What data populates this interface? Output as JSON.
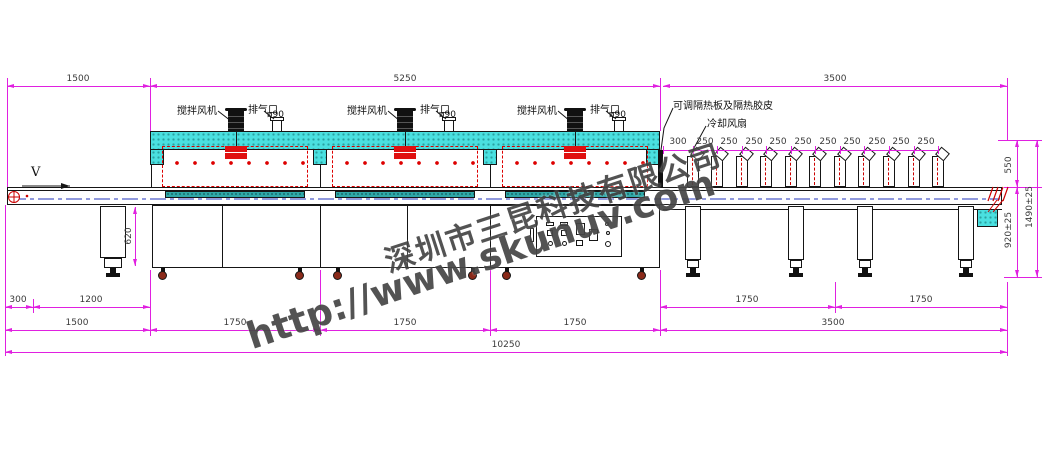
{
  "watermark": {
    "company": "深圳市三昆科技有限公司",
    "url": "http://www.skunuv.com"
  },
  "labels": {
    "stir_fan": "搅拌风机",
    "exhaust_port": "排气口",
    "exhaust_diameter": "ø90",
    "insulation": "可调隔热板及隔热胶皮",
    "cooling_fan": "冷却风扇",
    "direction": "V"
  },
  "dimensions": {
    "top": [
      "1500",
      "5250",
      "3500"
    ],
    "fan_spacing": [
      "300",
      "250",
      "250",
      "250",
      "250",
      "250",
      "250",
      "250",
      "250",
      "250",
      "250"
    ],
    "right_side": [
      "550",
      "920±25",
      "1490±25"
    ],
    "conveyor_height": "620",
    "bottom_upper_left": [
      "300",
      "1200"
    ],
    "bottom_upper_right": [
      "1750",
      "1750"
    ],
    "bottom_main": [
      "1500",
      "1750",
      "1750",
      "1750",
      "3500"
    ],
    "bottom_total": "10250"
  },
  "colors": {
    "dimension_line": "#e020e0",
    "insulation_fill": "#4ae0e0",
    "heater_red": "#e01010",
    "conveyor_strip": "#2fa8a8",
    "centerline_blue": "#2233bb"
  }
}
